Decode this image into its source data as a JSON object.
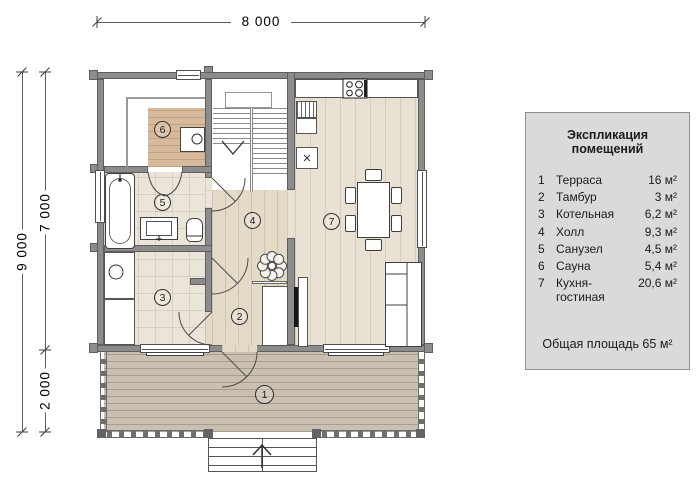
{
  "dimensions": {
    "width_top": "8 000",
    "height_total": "9 000",
    "height_house": "7 000",
    "height_terrace": "2 000"
  },
  "legend": {
    "title": "Экспликация помещений",
    "rows": [
      {
        "num": "1",
        "name": "Терраса",
        "area": "16 м²"
      },
      {
        "num": "2",
        "name": "Тамбур",
        "area": "3 м²"
      },
      {
        "num": "3",
        "name": "Котельная",
        "area": "6,2 м²"
      },
      {
        "num": "4",
        "name": "Холл",
        "area": "9,3 м²"
      },
      {
        "num": "5",
        "name": "Санузел",
        "area": "4,5 м²"
      },
      {
        "num": "6",
        "name": "Сауна",
        "area": "5,4 м²"
      },
      {
        "num": "7",
        "name": "Кухня-гостиная",
        "area": "20,6 м²"
      }
    ],
    "total": "Общая площадь 65 м²"
  },
  "plan": {
    "room_markers": [
      "1",
      "2",
      "3",
      "4",
      "5",
      "6",
      "7"
    ]
  },
  "colors": {
    "wall": "#8c8c8c",
    "wall_outline": "#5e5e5e",
    "sauna_wood": "#d7ba9c",
    "tile": "#ebe4d9",
    "hall_wood": "#e4dac8",
    "kitchen_wood": "#e9e1d3",
    "terrace_deck": "#c9c0b1",
    "legend_bg": "#dadada",
    "dim_line": "#5c5c5c"
  }
}
